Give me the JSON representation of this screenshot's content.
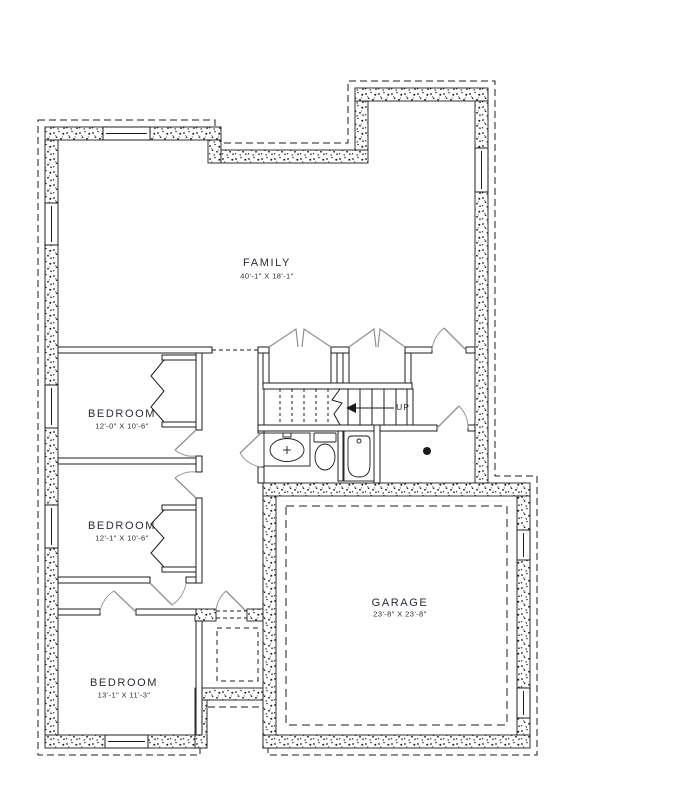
{
  "plan": {
    "rooms": [
      {
        "name": "FAMILY",
        "dims": "40'-1\" X 18'-1\""
      },
      {
        "name": "BEDROOM",
        "dims": "12'-0\" X 10'-6\""
      },
      {
        "name": "BEDROOM",
        "dims": "12'-1\" X 10'-6\""
      },
      {
        "name": "BEDROOM",
        "dims": "13'-1\" X 11'-3\""
      },
      {
        "name": "GARAGE",
        "dims": "23'-8\" X 23'-8\""
      }
    ],
    "stair_label": "UP",
    "colors": {
      "line": "#1c1c1c",
      "label": "#2b2b34",
      "door": "#909090",
      "background": "#ffffff"
    }
  }
}
